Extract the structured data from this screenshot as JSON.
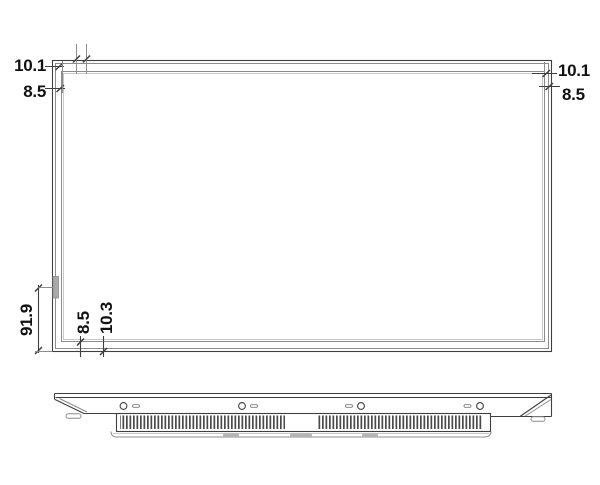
{
  "dimensions": {
    "top_left": {
      "outer": "10.1",
      "inner": "8.5"
    },
    "top_right": {
      "outer": "10.1",
      "inner": "8.5"
    },
    "left_side": {
      "sensor_offset": "91.9"
    },
    "bottom": {
      "inner": "8.5",
      "outer": "10.3"
    }
  },
  "colors": {
    "background": "#ffffff",
    "fill": "#ffffff",
    "line_dark": "#3f3f3f",
    "line_mid": "#8c8c8c",
    "line_light": "#c8c8c8",
    "tab": "#a9a9a9",
    "pad": "#b5b5b5",
    "text": "#111111"
  }
}
